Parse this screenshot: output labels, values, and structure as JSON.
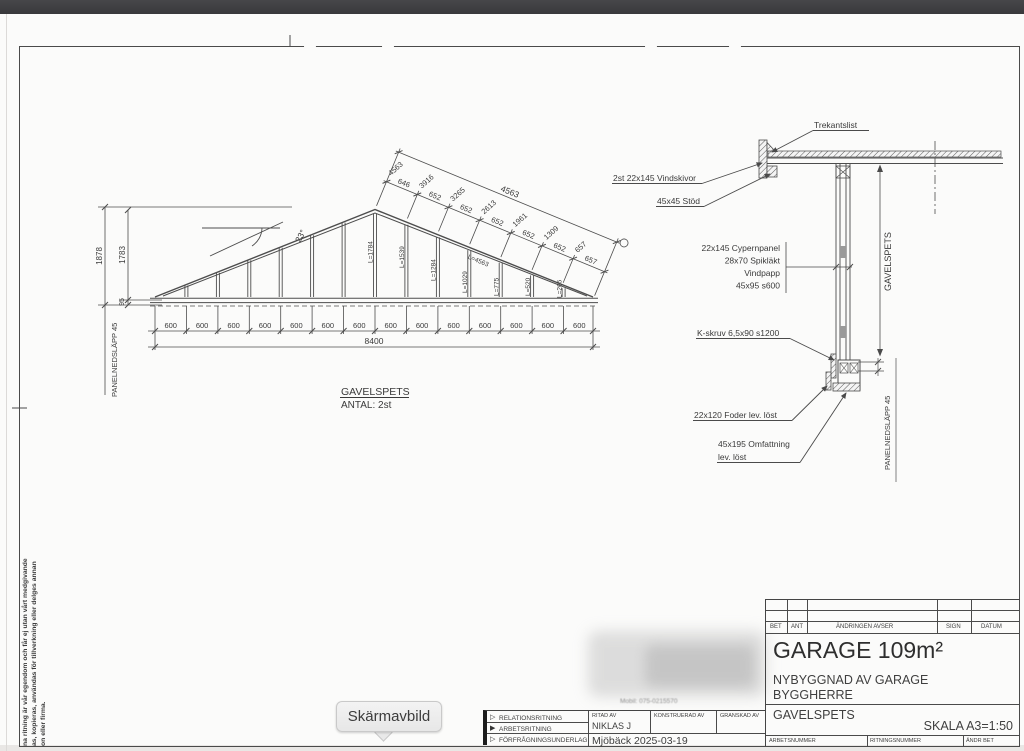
{
  "window": {
    "tooltip": "Skärmavbild"
  },
  "disclaimer": {
    "line1": "na ritning är vår egendom och får ej utan vårt medgivande",
    "line2": "as, kopieras, användas för tillverkning eller delges annan",
    "line3": "on eller firma."
  },
  "truss": {
    "title": "GAVELSPETS",
    "count": "ANTAL: 2st",
    "angle": "23°",
    "dim_total_h": "1878",
    "dim_inner_h": "1783",
    "dim_95": "95",
    "panel_label": "PANELNEDSLÄPP 45",
    "base_total": "8400",
    "base_dims": [
      "600",
      "600",
      "600",
      "600",
      "600",
      "600",
      "600",
      "600",
      "600",
      "600",
      "600",
      "600",
      "600",
      "600"
    ],
    "slope_total": "4563",
    "rafter_label": "L=4563",
    "slope_segments": [
      "646",
      "652",
      "652",
      "652",
      "652",
      "652",
      "657"
    ],
    "slope_cumulative": [
      "4563",
      "3916",
      "3265",
      "2613",
      "1961",
      "1309",
      "657"
    ],
    "studs": [
      "L=1784",
      "L=1539",
      "L=1284",
      "L=1029",
      "L=775",
      "L=520",
      "L=265"
    ]
  },
  "detail": {
    "trekantslist": "Trekantslist",
    "vindskivor": "2st 22x145 Vindskivor",
    "stod": "45x45 Stöd",
    "layers": [
      "22x145 Cypernpanel",
      "28x70 Spikläkt",
      "Vindpapp",
      "45x95 s600"
    ],
    "kskruv": "K-skruv 6,5x90 s1200",
    "foder": "22x120 Foder lev. löst",
    "omfattning_1": "45x195 Omfattning",
    "omfattning_2": "lev. löst",
    "gavelspets": "GAVELSPETS",
    "panel_label": "PANELNEDSLÄPP 45"
  },
  "infoblock": {
    "rows": [
      "RELATIONSRITNING",
      "ARBETSRITNING",
      "FÖRFRÅGNINGSUNDERLAG"
    ],
    "ritad_av_label": "RITAD AV",
    "ritad_av": "NIKLAS J",
    "konstruerad_label": "KONSTRUERAD AV",
    "granskad_label": "GRANSKAD AV",
    "place_date": "Mjöbäck 2025-03-19",
    "mobile": "Mobil: 075-0215570"
  },
  "titleblock": {
    "rev_headers": [
      "BET",
      "ANT",
      "ÄNDRINGEN AVSER",
      "SIGN",
      "DATUM"
    ],
    "project_title": "GARAGE 109m²",
    "sub1": "NYBYGGNAD AV GARAGE",
    "sub2": "BYGGHERRE",
    "drawing_name": "GAVELSPETS",
    "scale": "SKALA A3=1:50",
    "footer": [
      "ARBETSNUMMER",
      "RITNINGSNUMMER",
      "ÄNDR BET"
    ]
  }
}
